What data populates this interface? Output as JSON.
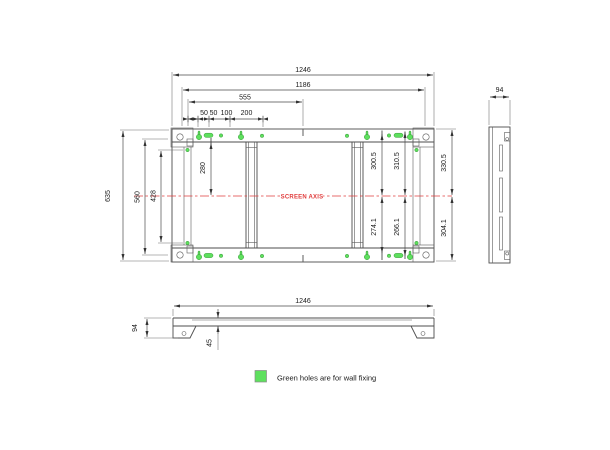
{
  "colors": {
    "green": "#5ee05e",
    "red": "#e03c3c",
    "line": "#4d4d4d"
  },
  "front_view": {
    "axis_label": "SCREEN AXIS",
    "dims": {
      "total_width": "1246",
      "hole_span": "1186",
      "half_span": "555",
      "spacing": [
        "50",
        "50",
        "100",
        "200"
      ],
      "total_height": "635",
      "rail_span": "560",
      "slot_span": "428",
      "axis_to_top_holes": "280",
      "upper_right": [
        "300.5",
        "310.5",
        "330.5"
      ],
      "lower_right": [
        "274.1",
        "266.1",
        "304.1"
      ]
    }
  },
  "side_view": {
    "dims": {
      "depth": "94"
    }
  },
  "bottom_view": {
    "dims": {
      "width": "1246",
      "height": "94",
      "inset": "45"
    }
  },
  "legend": {
    "text": "Green holes are for wall fixing"
  }
}
